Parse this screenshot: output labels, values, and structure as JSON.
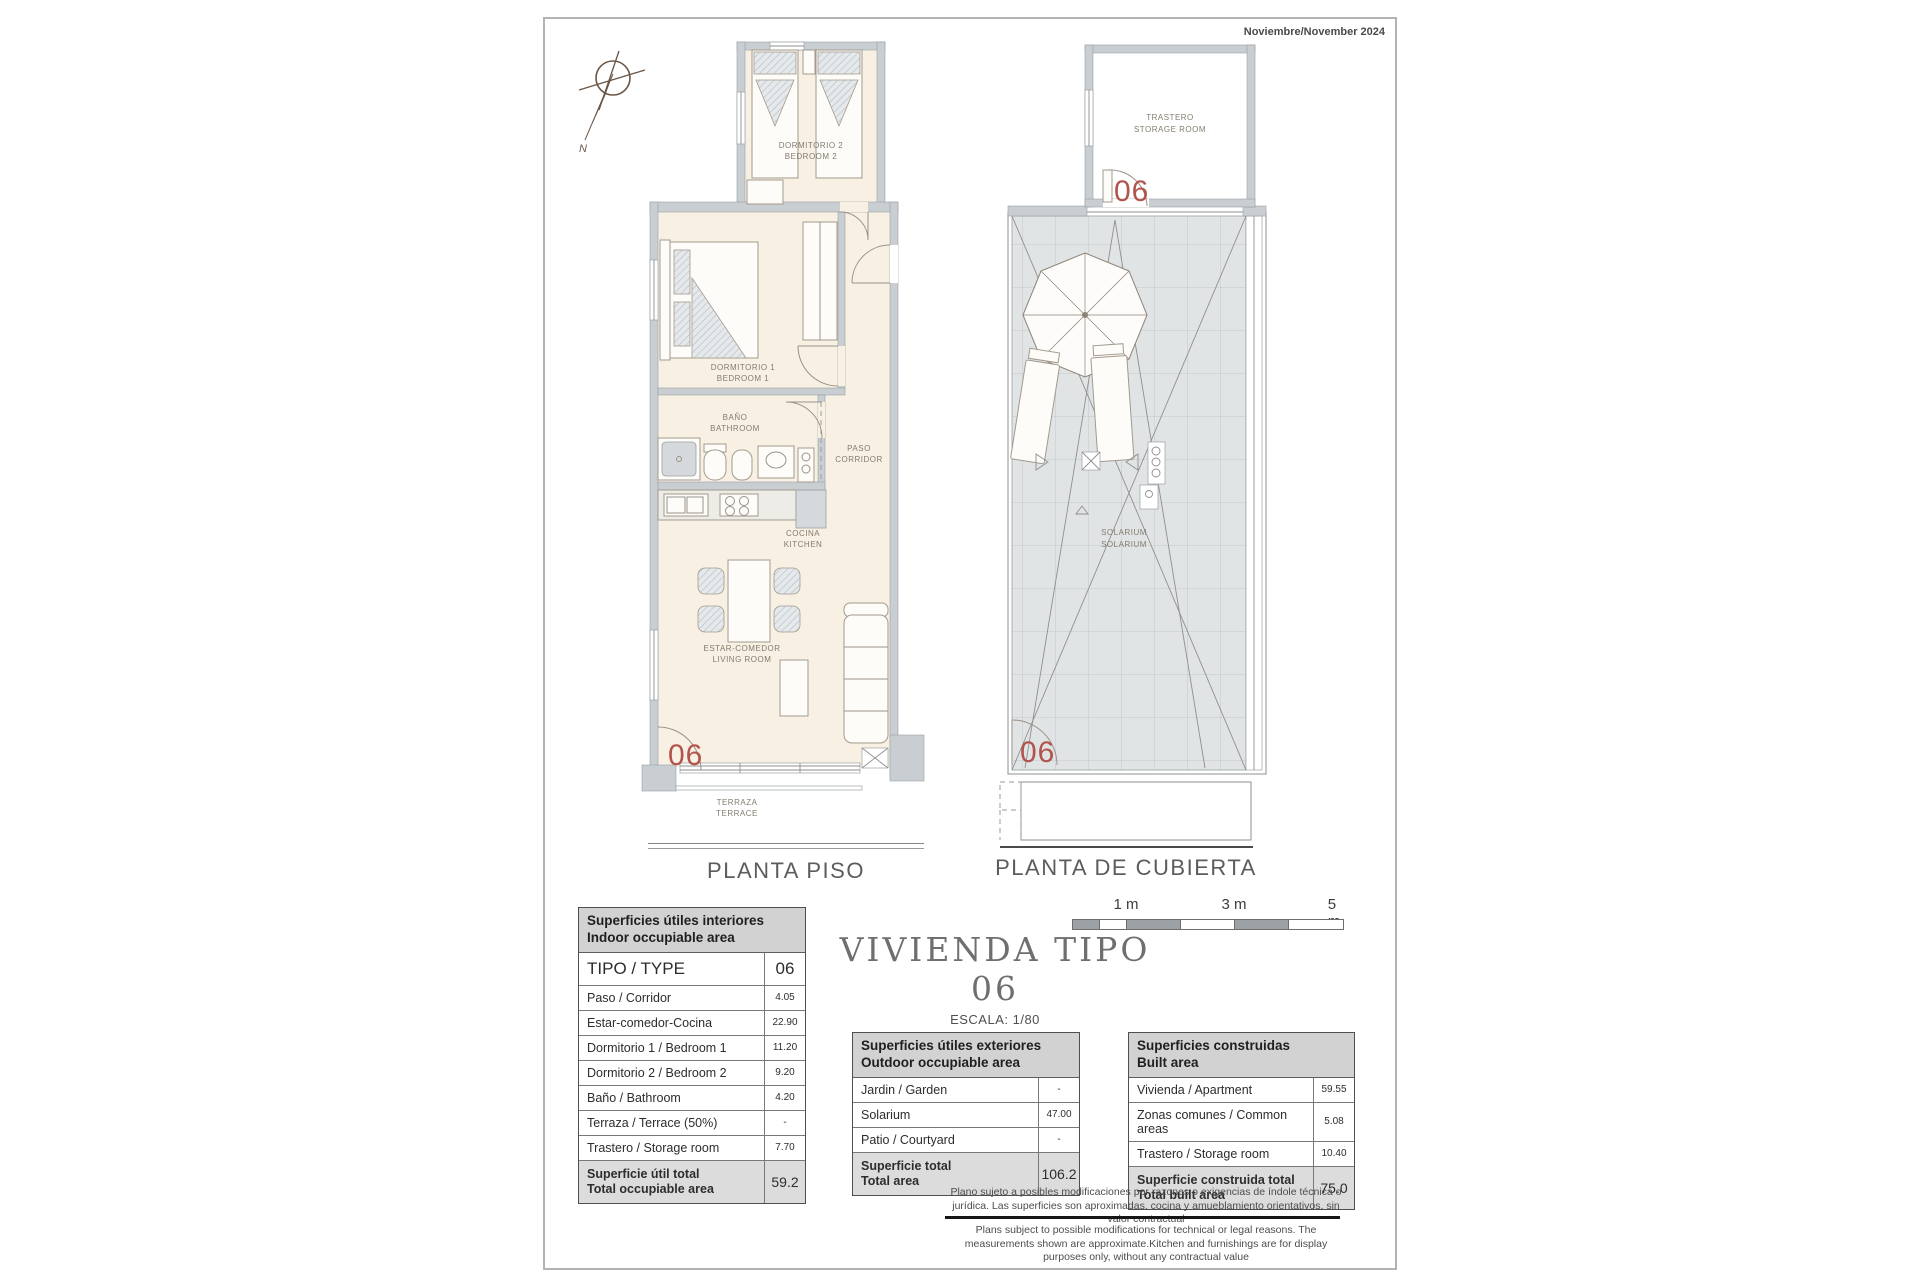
{
  "header": {
    "date": "Noviembre/November 2024"
  },
  "compass": {
    "label": "N"
  },
  "floor_plan": {
    "title": "PLANTA PISO",
    "unit": "06",
    "labels": {
      "bedroom2_es": "DORMITORIO 2",
      "bedroom2_en": "BEDROOM 2",
      "bedroom1_es": "DORMITORIO 1",
      "bedroom1_en": "BEDROOM 1",
      "bath_es": "BAÑO",
      "bath_en": "BATHROOM",
      "corridor_es": "PASO",
      "corridor_en": "CORRIDOR",
      "kitchen_es": "COCINA",
      "kitchen_en": "KITCHEN",
      "living_es": "ESTAR-COMEDOR",
      "living_en": "LIVING ROOM",
      "terrace_es": "TERRAZA",
      "terrace_en": "TERRACE"
    }
  },
  "roof_plan": {
    "title": "PLANTA DE CUBIERTA",
    "unit": "06",
    "labels": {
      "storage_es": "TRASTERO",
      "storage_en": "STORAGE ROOM",
      "solarium_es": "SOLARIUM",
      "solarium_en": "SOLARIUM"
    }
  },
  "title_block": {
    "title": "VIVIENDA TIPO 06",
    "scale": "ESCALA: 1/80"
  },
  "scale_bar": {
    "labels": [
      "1 m",
      "3 m",
      "5 m"
    ]
  },
  "tables": {
    "indoor": {
      "title_es": "Superficies útiles interiores",
      "title_en": "Indoor occupiable area",
      "type_label": "TIPO / TYPE",
      "type_value": "06",
      "rows": [
        {
          "label": "Paso / Corridor",
          "value": "4.05"
        },
        {
          "label": "Estar-comedor-Cocina",
          "value": "22.90"
        },
        {
          "label": "Dormitorio 1 / Bedroom 1",
          "value": "11.20"
        },
        {
          "label": "Dormitorio 2 / Bedroom 2",
          "value": "9.20"
        },
        {
          "label": "Baño / Bathroom",
          "value": "4.20"
        },
        {
          "label": "Terraza / Terrace (50%)",
          "value": "-"
        },
        {
          "label": "Trastero / Storage room",
          "value": "7.70"
        }
      ],
      "total_label_es": "Superficie útil total",
      "total_label_en": "Total occupiable area",
      "total_value": "59.2"
    },
    "outdoor": {
      "title_es": "Superficies útiles exteriores",
      "title_en": "Outdoor occupiable area",
      "rows": [
        {
          "label": "Jardin / Garden",
          "value": "-"
        },
        {
          "label": "Solarium",
          "value": "47.00"
        },
        {
          "label": "Patio / Courtyard",
          "value": "-"
        }
      ],
      "total_label_es": "Superficie total",
      "total_label_en": "Total area",
      "total_value": "106.2"
    },
    "built": {
      "title_es": "Superficies construidas",
      "title_en": "Built area",
      "rows": [
        {
          "label": "Vivienda / Apartment",
          "value": "59.55"
        },
        {
          "label": "Zonas comunes / Common areas",
          "value": "5.08"
        },
        {
          "label": "Trastero / Storage room",
          "value": "10.40"
        }
      ],
      "total_label_es": "Superficie construida total",
      "total_label_en": "Total built area",
      "total_value": "75.0"
    }
  },
  "disclaimer": {
    "es": "Plano sujeto a posibles modificaciones por razones o exigencias de índole técnica o jurídica. Las superficies son aproximadas. cocina y amueblamiento  orientativos, sin valor contractual",
    "en": "Plans subject to possible modifications for technical or legal reasons. The measurements shown are approximate.Kitchen and furnishings are for display purposes only, without any contractual value"
  },
  "colors": {
    "wall": "#c9ced2",
    "floor": "#f8f1e3",
    "roof_tile": "#e1e4e5",
    "accent_red": "#b2544e"
  }
}
